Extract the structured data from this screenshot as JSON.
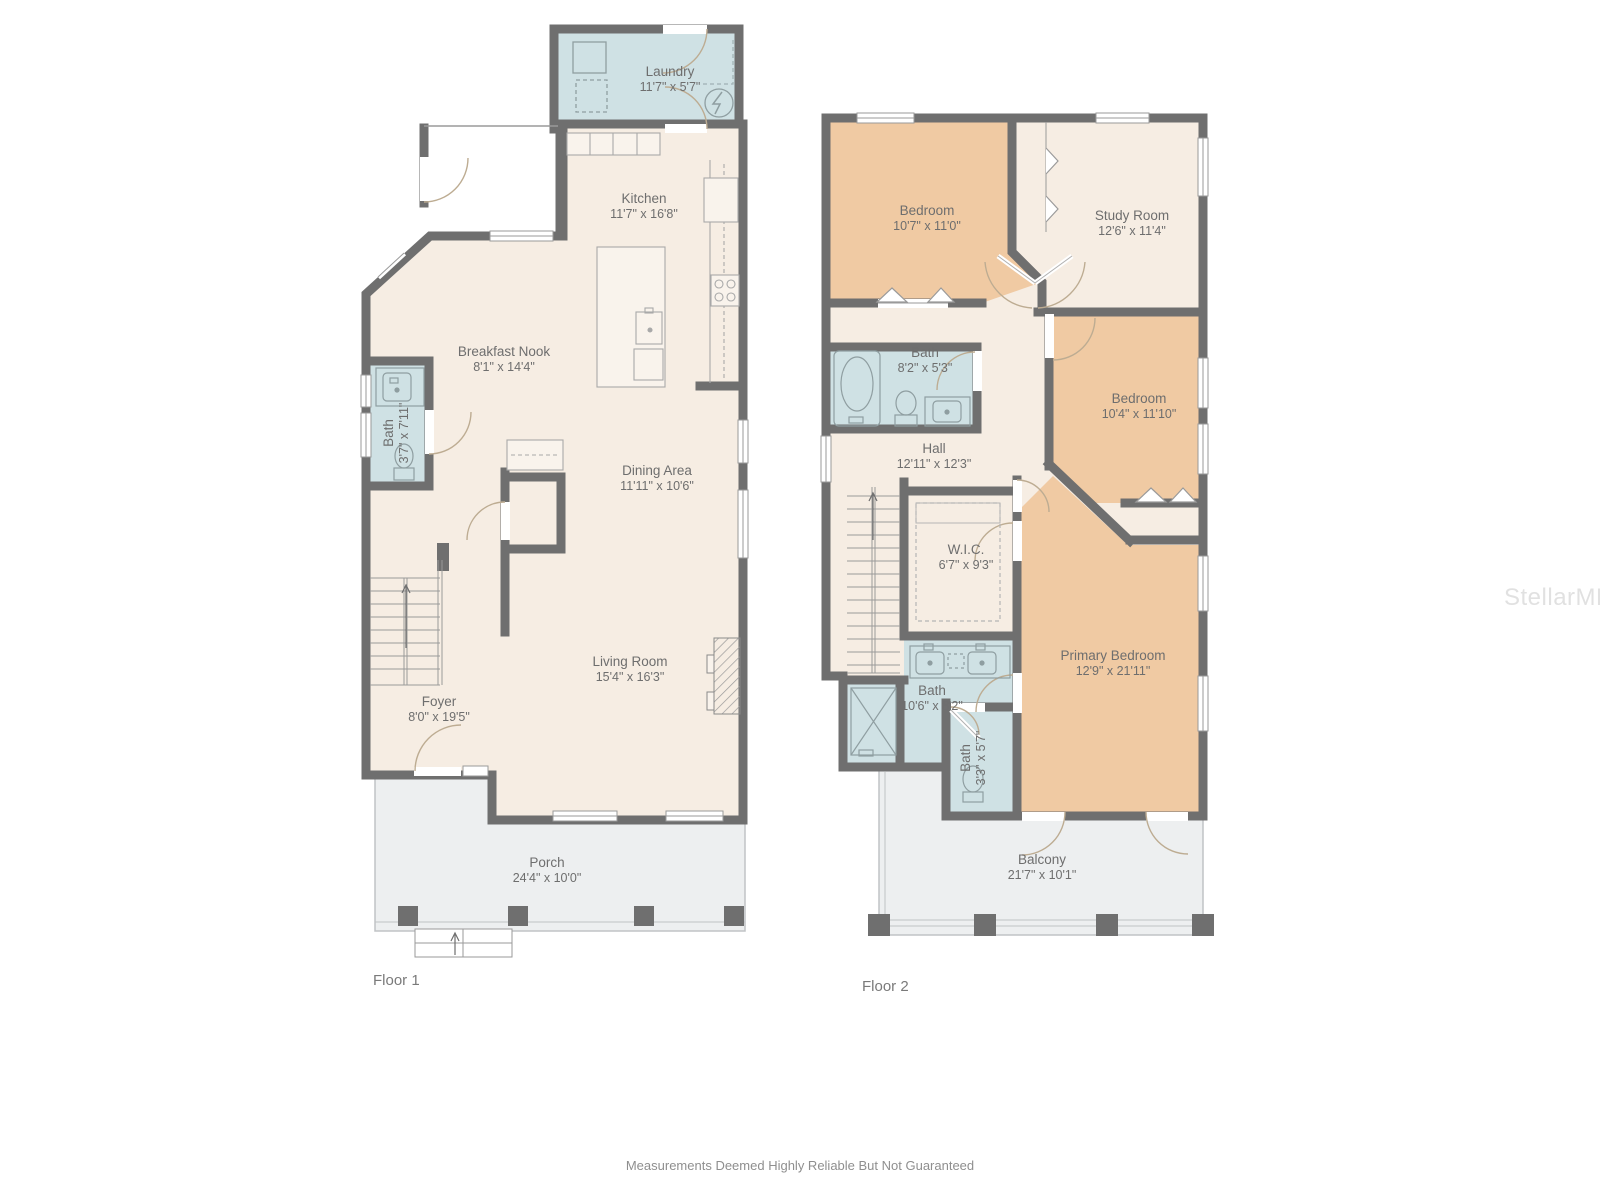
{
  "floors": [
    {
      "label": "Floor 1",
      "rooms": [
        {
          "name": "Laundry",
          "dims": "11'7\" x 5'7\""
        },
        {
          "name": "Kitchen",
          "dims": "11'7\" x 16'8\""
        },
        {
          "name": "Breakfast Nook",
          "dims": "8'1\" x 14'4\""
        },
        {
          "name": "Bath",
          "dims": "3'7\" x 7'11\""
        },
        {
          "name": "Dining Area",
          "dims": "11'11\" x 10'6\""
        },
        {
          "name": "Living Room",
          "dims": "15'4\" x 16'3\""
        },
        {
          "name": "Foyer",
          "dims": "8'0\" x 19'5\""
        },
        {
          "name": "Porch",
          "dims": "24'4\" x 10'0\""
        }
      ]
    },
    {
      "label": "Floor 2",
      "rooms": [
        {
          "name": "Bedroom",
          "dims": "10'7\" x 11'0\""
        },
        {
          "name": "Study Room",
          "dims": "12'6\" x 11'4\""
        },
        {
          "name": "Bath",
          "dims": "8'2\" x 5'3\""
        },
        {
          "name": "Bedroom",
          "dims": "10'4\" x 11'10\""
        },
        {
          "name": "Hall",
          "dims": "12'11\" x 12'3\""
        },
        {
          "name": "W.I.C.",
          "dims": "6'7\" x 9'3\""
        },
        {
          "name": "Primary Bedroom",
          "dims": "12'9\" x 21'11\""
        },
        {
          "name": "Bath",
          "dims": "10'6\" x 8'2\""
        },
        {
          "name": "Bath",
          "dims": "3'3\" x 5'7\""
        },
        {
          "name": "Balcony",
          "dims": "21'7\" x 10'1\""
        }
      ]
    }
  ],
  "watermark": "StellarMLS",
  "disclaimer": "Measurements Deemed Highly Reliable But Not Guaranteed",
  "colors": {
    "wall": "#6f6f6f",
    "floor": "#f6ede3",
    "bedroom": "#f0caa3",
    "bath": "#cfe1e4",
    "porch": "#edeff0"
  }
}
